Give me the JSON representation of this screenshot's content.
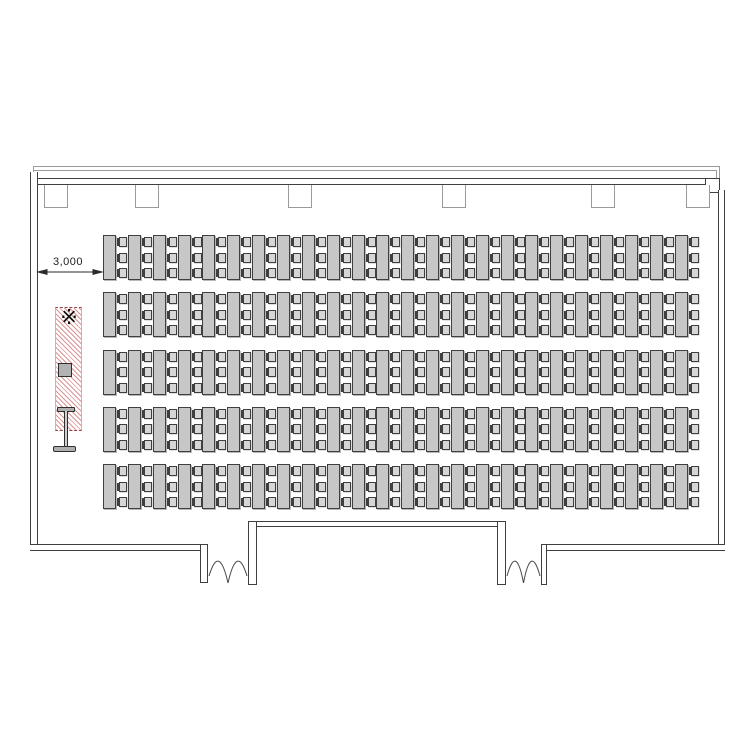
{
  "drawing": {
    "type": "room-floor-plan",
    "dimension_label": "3,000",
    "reference_mark": "※",
    "seating": {
      "table_rows": 5,
      "table_columns": 24,
      "chairs_per_table": 3,
      "total_tables": 120,
      "total_chairs": 360
    },
    "features": {
      "pillars_on_top_wall": 6,
      "double_doors": 2,
      "screen_strip": "hatched area with reference mark, equipment box and stand symbol"
    },
    "colors": {
      "wall_line": "#3f3f3f",
      "roof_line": "#9a9a9a",
      "table_fill": "#c7c7c7",
      "chair_fill": "#d6d6d6",
      "hatch": "#c25b5b",
      "equipment_fill": "#b3b3b3"
    }
  }
}
